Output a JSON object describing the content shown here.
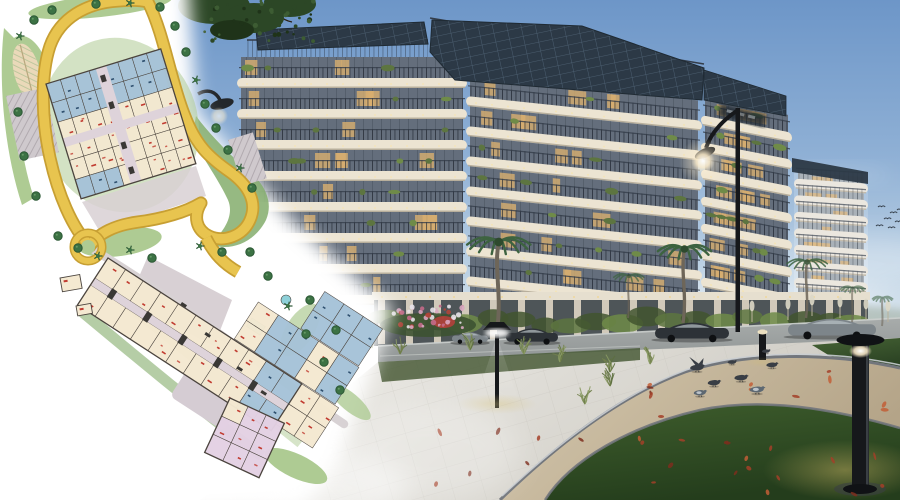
{
  "scene": {
    "type": "architectural-marketing-render",
    "elements": [
      "site-plan-overlay",
      "residential-building-render",
      "landscaped-walkway",
      "street-furniture",
      "pigeons"
    ]
  },
  "palette": {
    "sky_top": "#6d96c8",
    "sky_mid": "#8fb0d5",
    "sky_low": "#bdd2e4",
    "sky_horizon": "#e9eff3",
    "fascia": "#ece4d2",
    "fascia_shadow": "#b3a996",
    "recess": "#646e7c",
    "window_warm": "#d8af6f",
    "railing": "#343d4a",
    "pv": "#2c3946",
    "pv_line": "#53677a",
    "tower_fascia": "#e8e3d9",
    "tower_recess": "#99a2ab",
    "plant_dark": "#42552f",
    "plant_mid": "#5d7540",
    "plant_bright": "#6f8b48",
    "palm_leaf": "#3d6340",
    "palm_trunk": "#6e6659",
    "road": "#9aa09f",
    "kerb": "#cdd1cf",
    "car_dark": "#2d3237",
    "car_grey": "#7d858a",
    "pavement_a": "#f2f1ed",
    "pavement_b": "#ccc9c1",
    "tile_joint": "#bfbdb5",
    "sand_a": "#d5c8ae",
    "sand_b": "#b4a488",
    "edge_dark": "#72767c",
    "edge_light": "#c9cdd1",
    "lawn_a": "#3f5e2d",
    "lawn_b": "#243d1c",
    "lawn_lit": "#7e9a42",
    "leaf_1": "#a33f28",
    "leaf_2": "#c25e36",
    "leaf_3": "#7c2e1d",
    "black_fixture": "#16181b",
    "glow_warm": "#f6e9c8",
    "pigeon_dark": "#393e45",
    "pigeon_blue": "#5d6872",
    "pigeon_light": "#ccd3d8",
    "foliage": "#2c4726",
    "haze_green": "#93a291"
  },
  "render": {
    "building_sections": [
      {
        "id": "d",
        "label": "far-tower",
        "x": 794,
        "w": 74,
        "top": 172,
        "floors": 9,
        "fh": 16.5,
        "skew": 4,
        "far": true
      },
      {
        "id": "c",
        "label": "right-curve",
        "x": 701,
        "w": 91,
        "top": 98,
        "floors": 8,
        "fh": 27,
        "skew": 11
      },
      {
        "id": "b",
        "label": "center-wing",
        "x": 466,
        "w": 236,
        "top": 76,
        "floors": 8,
        "fh": 30,
        "skew": 6
      },
      {
        "id": "a",
        "label": "left-wing",
        "x": 237,
        "w": 230,
        "top": 57,
        "floors": 8,
        "fh": 31,
        "skew": 0
      }
    ],
    "palms": [
      {
        "x": 497,
        "y": 330,
        "h": 88,
        "o": 1
      },
      {
        "x": 683,
        "y": 323,
        "h": 74,
        "o": 1
      },
      {
        "x": 806,
        "y": 318,
        "h": 56,
        "o": 0.85
      },
      {
        "x": 852,
        "y": 322,
        "h": 34,
        "o": 0.6
      },
      {
        "x": 882,
        "y": 326,
        "h": 28,
        "o": 0.55
      },
      {
        "x": 628,
        "y": 318,
        "h": 42,
        "o": 0.7
      }
    ],
    "cars": [
      {
        "x": 452,
        "y": 332,
        "w": 36,
        "h": 10,
        "c": "grey"
      },
      {
        "x": 506,
        "y": 328,
        "w": 52,
        "h": 14,
        "c": "dark"
      },
      {
        "x": 655,
        "y": 322,
        "w": 74,
        "h": 17,
        "c": "dark"
      },
      {
        "x": 788,
        "y": 318,
        "w": 88,
        "h": 18,
        "c": "grey"
      }
    ],
    "pigeons": [
      {
        "x": 697,
        "y": 369,
        "t": "fly",
        "s": 1.1
      },
      {
        "x": 714,
        "y": 384,
        "t": "walk",
        "s": 1
      },
      {
        "x": 741,
        "y": 379,
        "t": "walk",
        "s": 1.05
      },
      {
        "x": 757,
        "y": 391,
        "t": "blue",
        "s": 1.15
      },
      {
        "x": 772,
        "y": 366,
        "t": "walk",
        "s": 0.9
      },
      {
        "x": 732,
        "y": 363,
        "t": "walk",
        "s": 0.7
      },
      {
        "x": 766,
        "y": 352,
        "t": "walk",
        "s": 0.65
      },
      {
        "x": 700,
        "y": 394,
        "t": "blue",
        "s": 1
      }
    ],
    "flying_birds": [
      [
        878,
        207
      ],
      [
        890,
        213
      ],
      [
        884,
        219
      ],
      [
        895,
        222
      ],
      [
        876,
        226
      ],
      [
        897,
        210
      ],
      [
        888,
        228
      ]
    ],
    "fallen_leaves": {
      "count": 36,
      "zones": [
        [
          620,
          888,
          368,
          424
        ],
        [
          430,
          690,
          430,
          495
        ],
        [
          700,
          888,
          432,
          495
        ]
      ]
    },
    "grass_clusters": [
      [
        372,
        348
      ],
      [
        400,
        354
      ],
      [
        524,
        354
      ],
      [
        560,
        362
      ],
      [
        610,
        372
      ],
      [
        650,
        364
      ],
      [
        585,
        404
      ],
      [
        610,
        386
      ],
      [
        470,
        350
      ]
    ],
    "pampas": [
      [
        752,
        322
      ],
      [
        788,
        320
      ],
      [
        812,
        316
      ],
      [
        840,
        318
      ],
      [
        866,
        320
      ],
      [
        888,
        322
      ]
    ],
    "street_lights": {
      "tall_lamp": {
        "x": 737,
        "top": 108,
        "bottom": 332
      },
      "plan_edge_lamp": {
        "x": 214,
        "y": 104
      },
      "mushroom": {
        "x": 497,
        "y": 330
      },
      "bollard_small": {
        "x": 762,
        "y": 330
      },
      "bollard_large": {
        "x": 860,
        "y": 340
      }
    }
  },
  "site_plan": {
    "palette": {
      "paper": "#ffffff",
      "road": "#e8c44f",
      "road_casing": "#c79f33",
      "green_a": "#aecb93",
      "green_b": "#84ad6c",
      "tree": "#3c7244",
      "tree_dark": "#2c5835",
      "cream": "#f4e9d1",
      "blue": "#a6c3d8",
      "blue_dark": "#2e4f6e",
      "pink": "#e4d1e4",
      "teal": "#8ed1d9",
      "outline": "#4b443e",
      "red": "#c13b30",
      "corridor": "#ded3da",
      "plaza": "#d8d0d4",
      "parking": "#cfc9cd",
      "path_grey": "#d8d2d4",
      "core": "#3a3835"
    },
    "roundabout": {
      "x": 88,
      "y": 247,
      "r": 14
    },
    "blocks": [
      {
        "name": "upper-residential-block",
        "x": 46,
        "y": 84,
        "rot": -17,
        "cols": 8,
        "rows": 6,
        "cw": 15,
        "rh": 20,
        "rule": "upper",
        "corridors": [
          {
            "x": 52,
            "y": 0,
            "w": 11,
            "h": 120
          },
          {
            "x": 0,
            "y": 57,
            "w": 120,
            "h": 9
          }
        ],
        "cores": [
          {
            "x": 54,
            "y": 8,
            "w": 5,
            "h": 7
          },
          {
            "x": 54,
            "y": 36,
            "w": 5,
            "h": 7
          },
          {
            "x": 54,
            "y": 78,
            "w": 5,
            "h": 7
          },
          {
            "x": 54,
            "y": 104,
            "w": 5,
            "h": 7
          }
        ]
      },
      {
        "name": "lower-residential-strip",
        "x": 108,
        "y": 258,
        "rot": 33,
        "cols": 11,
        "rows": 2,
        "cw": 21,
        "rh": 24,
        "gap": 8,
        "rule": "strip",
        "ext": [
          {
            "lx": 150,
            "ly": -45,
            "cols": 5,
            "rows": 2,
            "cw": 24,
            "rh": 22,
            "rule": "mixblue"
          },
          {
            "lx": 200,
            "ly": -90,
            "cols": 3,
            "rows": 2,
            "cw": 23,
            "rh": 22,
            "rule": "blue"
          },
          {
            "lx": 231,
            "ly": 0,
            "cols": 2,
            "rows": 2,
            "cw": 22,
            "rh": 24,
            "rule": "cream"
          }
        ],
        "corridors": [
          {
            "x": 0,
            "y": 24,
            "w": 231,
            "h": 8
          }
        ],
        "cores": [
          {
            "x": 20,
            "y": 23,
            "w": 6,
            "h": 10
          },
          {
            "x": 62,
            "y": 23,
            "w": 6,
            "h": 10
          },
          {
            "x": 104,
            "y": 23,
            "w": 6,
            "h": 10
          },
          {
            "x": 146,
            "y": 23,
            "w": 6,
            "h": 10
          },
          {
            "x": 188,
            "y": 23,
            "w": 6,
            "h": 10
          }
        ]
      },
      {
        "name": "tip-block",
        "x": 230,
        "y": 398,
        "rot": 25,
        "cols": 3,
        "rows": 3,
        "cw": 20,
        "rh": 20,
        "rule": "pink"
      }
    ],
    "amenity_blocks": [
      {
        "x": 60,
        "y": 278,
        "rot": -10,
        "w": 20,
        "h": 14
      },
      {
        "x": 76,
        "y": 306,
        "rot": -10,
        "w": 15,
        "h": 10
      }
    ],
    "plaza_marks": [
      [
        182,
        302
      ],
      [
        206,
        332
      ],
      [
        238,
        366
      ],
      [
        262,
        390
      ]
    ],
    "trees": [
      [
        20,
        36
      ],
      [
        34,
        20
      ],
      [
        52,
        10
      ],
      [
        96,
        4
      ],
      [
        130,
        3
      ],
      [
        160,
        7
      ],
      [
        175,
        26
      ],
      [
        186,
        52
      ],
      [
        196,
        80
      ],
      [
        205,
        104
      ],
      [
        216,
        128
      ],
      [
        228,
        150
      ],
      [
        240,
        168
      ],
      [
        252,
        188
      ],
      [
        58,
        236
      ],
      [
        78,
        248
      ],
      [
        98,
        256
      ],
      [
        36,
        196
      ],
      [
        24,
        156
      ],
      [
        18,
        112
      ],
      [
        130,
        250
      ],
      [
        152,
        258
      ],
      [
        250,
        252
      ],
      [
        268,
        276
      ],
      [
        288,
        306
      ],
      [
        306,
        334
      ],
      [
        324,
        362
      ],
      [
        340,
        390
      ],
      [
        200,
        246
      ],
      [
        222,
        252
      ],
      [
        310,
        300
      ],
      [
        336,
        330
      ]
    ]
  }
}
